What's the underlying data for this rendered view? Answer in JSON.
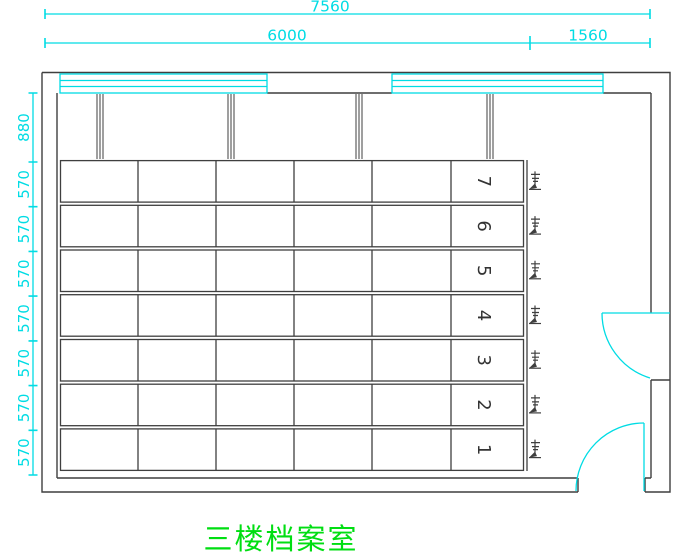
{
  "drawing": {
    "title": "三楼档案室",
    "colors": {
      "line": "#3f3f3f",
      "annotation": "#00dce4",
      "title": "#00de12",
      "background": "#ffffff"
    },
    "dimensions": {
      "horizontal": {
        "overall": "7560",
        "segments": [
          "6000",
          "1560"
        ]
      },
      "vertical": [
        "880",
        "570",
        "570",
        "570",
        "570",
        "570",
        "570",
        "570"
      ]
    },
    "shelving": {
      "row_numbers": [
        "7",
        "6",
        "5",
        "4",
        "3",
        "2",
        "1"
      ],
      "columns_per_row": 6,
      "crank_count": 7
    },
    "window_count": 2,
    "door_count": 2
  }
}
